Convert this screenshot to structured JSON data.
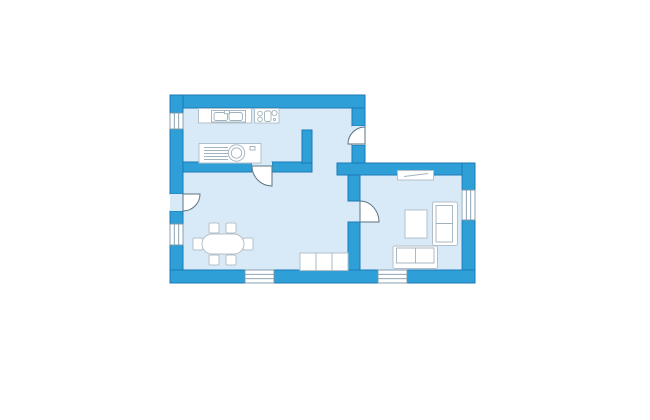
{
  "canvas": {
    "width": 650,
    "height": 420
  },
  "colors": {
    "background": "#ffffff",
    "wall_fill": "#2F9FD8",
    "wall_outline": "#1A79B4",
    "floor": "#D8EAF8",
    "furniture_fill": "#FFFFFF",
    "furniture_outline": "#B4C0C9",
    "furniture_detail": "#9FB2BD",
    "door_outline": "#5A7482",
    "window_frame": "#7D97A8"
  },
  "floor_plan": {
    "rooms": [
      {
        "name": "kitchen-area"
      },
      {
        "name": "living-dining-room"
      },
      {
        "name": "lounge-room"
      }
    ],
    "doors": [
      "entrance-door",
      "kitchen-door",
      "side-door",
      "lounge-door"
    ],
    "windows": [
      "left-upper-window",
      "left-lower-window",
      "bottom-left-window",
      "bottom-right-window",
      "right-window"
    ],
    "furniture": [
      "kitchen-counter-with-sink",
      "stove",
      "washing-machine",
      "dining-table",
      "dining-chairs",
      "sideboard",
      "wall-shelf",
      "coffee-table",
      "loveseat",
      "sofa"
    ]
  }
}
